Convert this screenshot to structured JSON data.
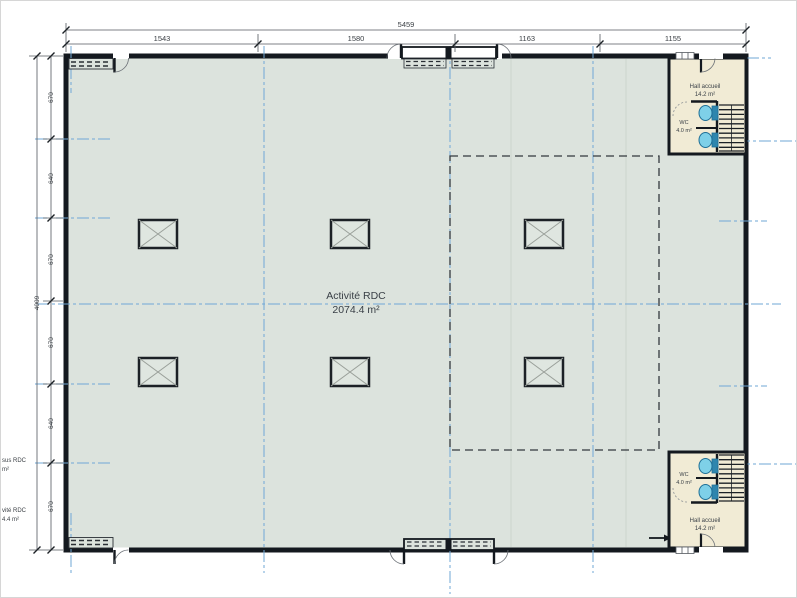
{
  "drawing": {
    "floor_label": {
      "name": "Activité RDC",
      "area": "2074.4 m²"
    },
    "dimensions": {
      "top_total": "5459",
      "top_segments": [
        "1543",
        "1580",
        "1163",
        "1155"
      ],
      "left_total": "4009",
      "left_segments": [
        "670",
        "640",
        "670",
        "670",
        "640",
        "670"
      ]
    },
    "rooms": {
      "hall_top": {
        "name": "Hall accueil",
        "area": "14.2 m²"
      },
      "wc_top": {
        "name": "WC",
        "area": "4.0 m²"
      },
      "hall_bottom": {
        "name": "Hall accueil",
        "area": "14.2 m²"
      },
      "wc_bottom": {
        "name": "WC",
        "area": "4.0 m²"
      }
    },
    "edge_labels": {
      "label1_line1": "sus RDC",
      "label1_line2": "m²",
      "label2_line1": "vité RDC",
      "label2_line2": "4.4 m²"
    },
    "colors": {
      "floor": "#dce3dd",
      "room_fill": "#f1ebd5",
      "wall": "#14191f",
      "axis_blue": "#6fa7d6",
      "dimension_line": "#54595f",
      "fixture_blue": "#7ed0e8",
      "fixture_dark_blue": "#2f86ae"
    }
  }
}
